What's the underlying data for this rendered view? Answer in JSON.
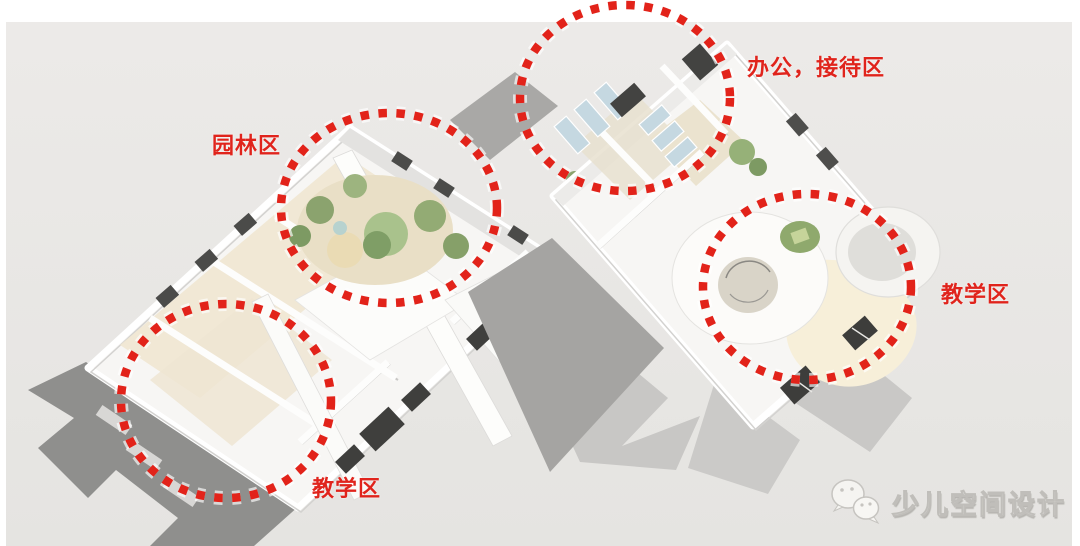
{
  "diagram": {
    "type": "axonometric-floorplan-annotation",
    "subject": "children-space-building-zoning",
    "background_color": "#e8e7e4",
    "accent_red": "#e2231a",
    "label_red": "#e0241c",
    "zones": {
      "garden": {
        "label": "园林区"
      },
      "office": {
        "label": "办公，接待区"
      },
      "teaching_right": {
        "label": "教学区"
      },
      "teaching_left": {
        "label": "教学区"
      }
    },
    "watermark": {
      "text": "少儿空间设计",
      "icon": "wechat-icon"
    }
  }
}
